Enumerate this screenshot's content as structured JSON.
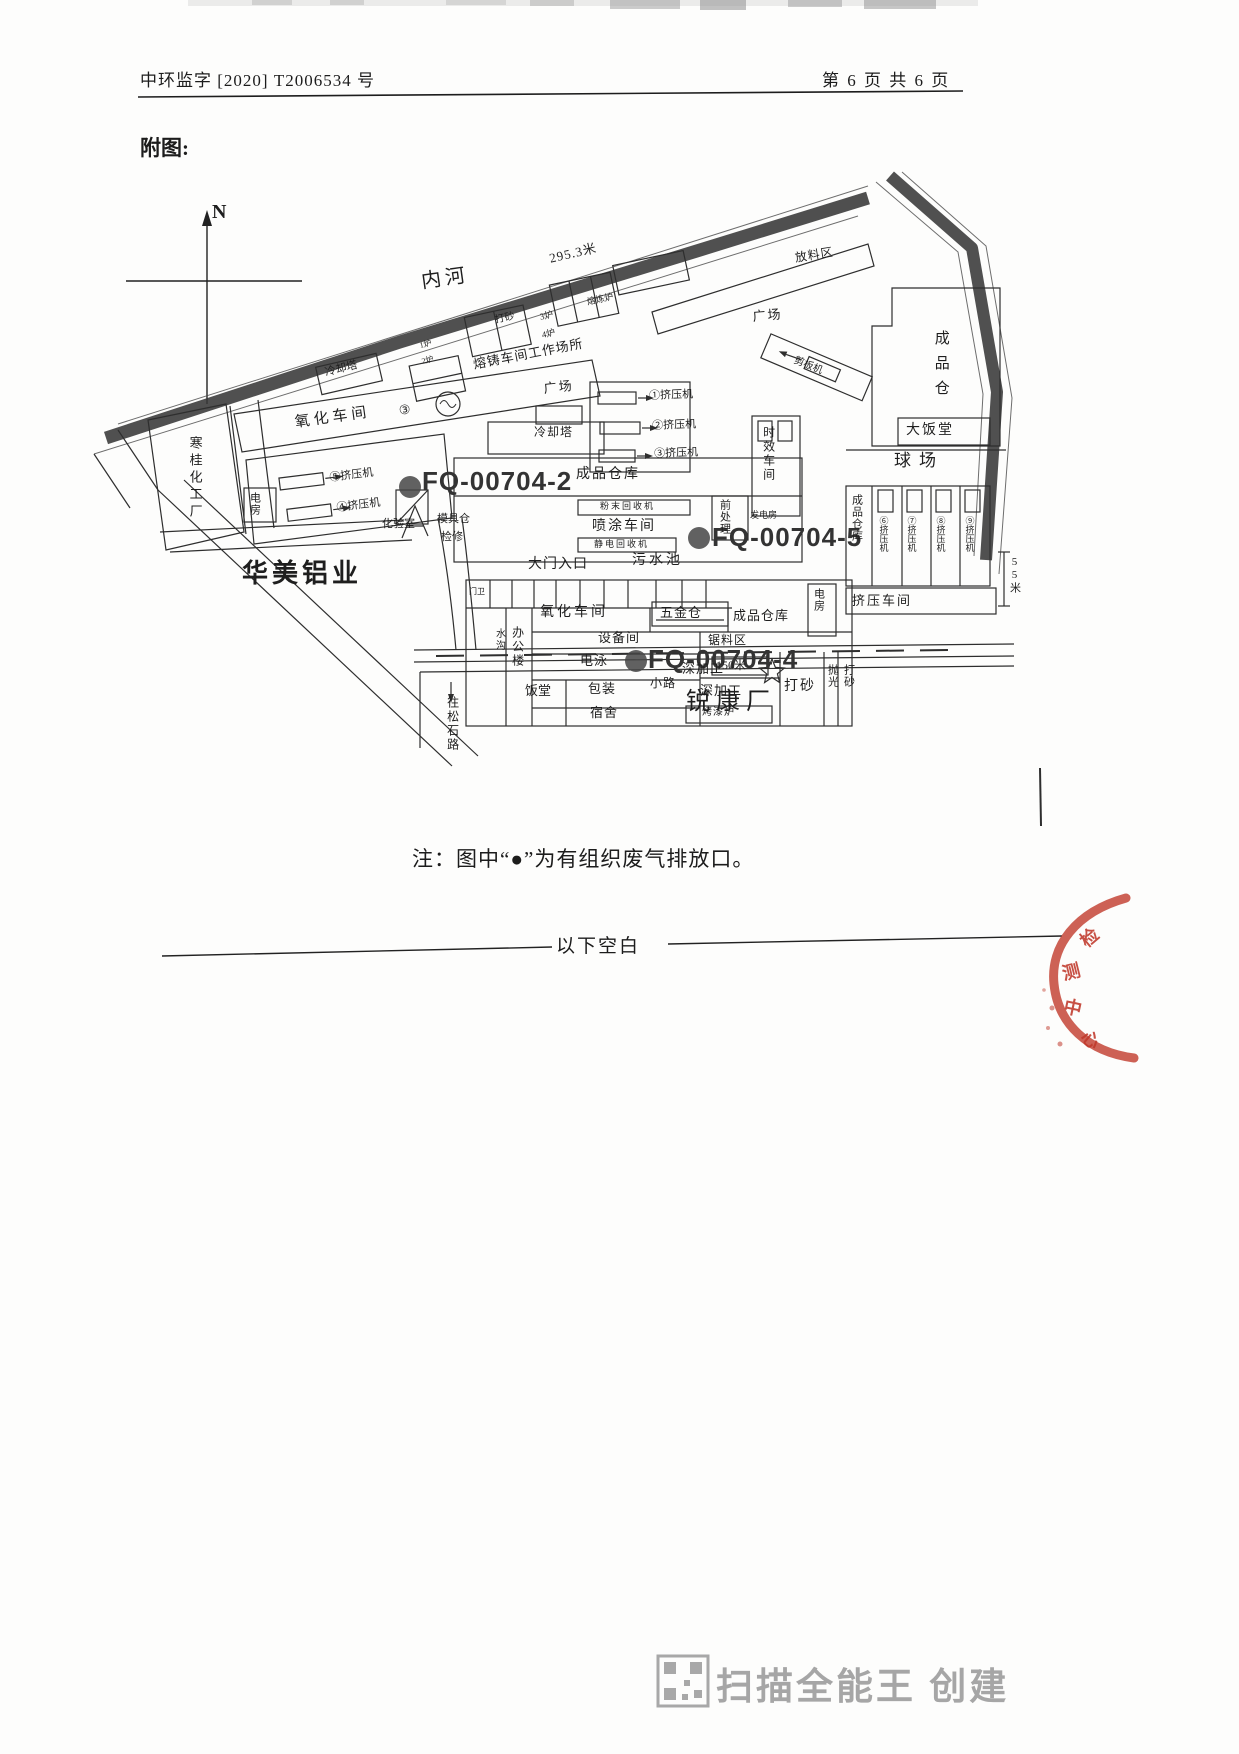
{
  "page": {
    "header_left": "中环监字  [2020]  T2006534 号",
    "header_right": "第 6 页 共 6 页",
    "figure_label": "附图:",
    "note": "注：图中“●”为有组织废气排放口。",
    "blank_marker": "以下空白",
    "watermark": "扫描全能王 创建",
    "stamp_text": "检测中心",
    "compass": "N"
  },
  "map": {
    "emission_outlets": [
      {
        "id": "fq-00704-2",
        "label": "FQ-00704-2"
      },
      {
        "id": "fq-00704-5",
        "label": "FQ-00704-5"
      },
      {
        "id": "fq-00704-4",
        "label": "FQ-00704-4"
      }
    ],
    "labels": [
      {
        "id": "compass-n",
        "text": "N"
      },
      {
        "id": "river-name",
        "text": "内河"
      },
      {
        "id": "river-length",
        "text": "295.3米"
      },
      {
        "id": "stockyard",
        "text": "放料区"
      },
      {
        "id": "plaza-north",
        "text": "广场"
      },
      {
        "id": "plaza-west",
        "text": "广场"
      },
      {
        "id": "finished-goods-store",
        "text": "成品仓"
      },
      {
        "id": "canteen-large",
        "text": "大饭堂"
      },
      {
        "id": "ball-court",
        "text": "球场"
      },
      {
        "id": "aging-workshop",
        "text": "时效车间"
      },
      {
        "id": "outlet-label-fq2",
        "text": "FQ-00704-2"
      },
      {
        "id": "outlet-label-fq5",
        "text": "FQ-00704-5"
      },
      {
        "id": "outlet-label-fq4",
        "text": "FQ-00704-4"
      },
      {
        "id": "finished-warehouse-center",
        "text": "成品仓库"
      },
      {
        "id": "spray-workshop",
        "text": "喷涂车间"
      },
      {
        "id": "powder-recycler",
        "text": "粉末回收机"
      },
      {
        "id": "electrostatic-recycler",
        "text": "静电回收机"
      },
      {
        "id": "sewage-pool",
        "text": "污水池"
      },
      {
        "id": "main-gate",
        "text": "大门入口"
      },
      {
        "id": "pretreatment",
        "text": "前处理"
      },
      {
        "id": "generator-room",
        "text": "发电房"
      },
      {
        "id": "oxidation-workshop-north",
        "text": "氧化车间"
      },
      {
        "id": "circled-3",
        "text": "③"
      },
      {
        "id": "oxidation-workshop-south",
        "text": "氧化车间"
      },
      {
        "id": "equipment-room",
        "text": "设备间"
      },
      {
        "id": "electrophoresis",
        "text": "电泳"
      },
      {
        "id": "packing",
        "text": "包装"
      },
      {
        "id": "dormitory",
        "text": "宿舍"
      },
      {
        "id": "canteen",
        "text": "饭堂"
      },
      {
        "id": "office-building",
        "text": "办公楼"
      },
      {
        "id": "ditch",
        "text": "水沟"
      },
      {
        "id": "hardware-store",
        "text": "五金仓"
      },
      {
        "id": "finished-warehouse-south",
        "text": "成品仓库"
      },
      {
        "id": "power-room-east",
        "text": "电房"
      },
      {
        "id": "saw-area",
        "text": "锯料区"
      },
      {
        "id": "deep-processing-1",
        "text": "深加工"
      },
      {
        "id": "deep-processing-2",
        "text": "深加工"
      },
      {
        "id": "paint-oven",
        "text": "烤漆炉"
      },
      {
        "id": "sandblast-south",
        "text": "打砂"
      },
      {
        "id": "polishing-col",
        "text": "抛光"
      },
      {
        "id": "sandblast-east-col",
        "text": "打砂"
      },
      {
        "id": "finished-warehouse-east",
        "text": "成品仓库"
      },
      {
        "id": "dim-55m",
        "text": "55米"
      },
      {
        "id": "extrusion-workshop",
        "text": "挤压车间"
      },
      {
        "id": "extruder-1",
        "text": "①挤压机"
      },
      {
        "id": "extruder-2",
        "text": "②挤压机"
      },
      {
        "id": "extruder-3",
        "text": "③挤压机"
      },
      {
        "id": "extruder-4",
        "text": "④挤压机"
      },
      {
        "id": "extruder-5",
        "text": "⑤挤压机"
      },
      {
        "id": "extruder-6",
        "text": "⑥挤压机"
      },
      {
        "id": "extruder-7",
        "text": "⑦挤压机"
      },
      {
        "id": "extruder-8",
        "text": "⑧挤压机"
      },
      {
        "id": "extruder-9",
        "text": "⑨挤压机"
      },
      {
        "id": "chemical-plant",
        "text": "寒桂化工厂"
      },
      {
        "id": "power-room-west",
        "text": "电房"
      },
      {
        "id": "lab",
        "text": "化验室"
      },
      {
        "id": "mold-store",
        "text": "模具仓"
      },
      {
        "id": "maintenance",
        "text": "检修"
      },
      {
        "id": "cooling-tower-1",
        "text": "冷却塔"
      },
      {
        "id": "cooling-tower-2",
        "text": "冷却塔"
      },
      {
        "id": "casting-worksite",
        "text": "熔铸车间工作场所"
      },
      {
        "id": "sandblast-north",
        "text": "打砂"
      },
      {
        "id": "furnace-3",
        "text": "3炉"
      },
      {
        "id": "furnace-4",
        "text": "4炉"
      },
      {
        "id": "furnace-1",
        "text": "1炉"
      },
      {
        "id": "furnace-2",
        "text": "2炉"
      },
      {
        "id": "melting-furnace",
        "text": "熔炼炉"
      },
      {
        "id": "plate-shear",
        "text": "剪板机"
      },
      {
        "id": "huamei",
        "text": "华美铝业"
      },
      {
        "id": "ruikang",
        "text": "锐康厂"
      },
      {
        "id": "path-label",
        "text": "小路"
      },
      {
        "id": "dim-150m",
        "text": "150米"
      },
      {
        "id": "songshi-road",
        "text": "往松石路"
      },
      {
        "id": "gatehouse",
        "text": "门卫"
      }
    ]
  }
}
